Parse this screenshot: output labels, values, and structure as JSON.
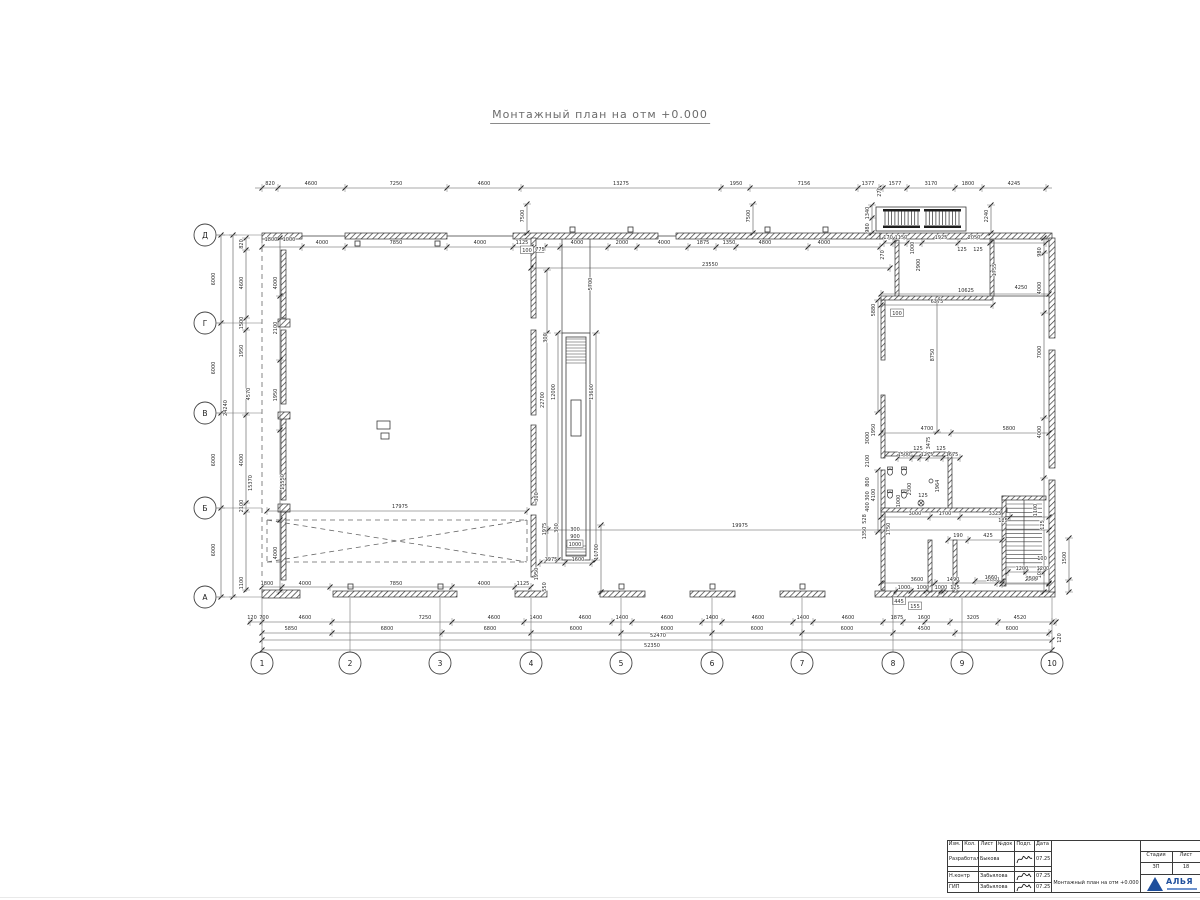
{
  "page": {
    "title": "Монтажный план на отм +0.000"
  },
  "plan": {
    "axes_bottom": [
      {
        "label": "1",
        "x": 262
      },
      {
        "label": "2",
        "x": 350
      },
      {
        "label": "3",
        "x": 440
      },
      {
        "label": "4",
        "x": 531
      },
      {
        "label": "5",
        "x": 621
      },
      {
        "label": "6",
        "x": 712
      },
      {
        "label": "7",
        "x": 802
      },
      {
        "label": "8",
        "x": 893
      },
      {
        "label": "9",
        "x": 962
      },
      {
        "label": "10",
        "x": 1052
      }
    ],
    "axes_left": [
      {
        "label": "Д",
        "y": 235
      },
      {
        "label": "Г",
        "y": 323
      },
      {
        "label": "В",
        "y": 413
      },
      {
        "label": "Б",
        "y": 508
      },
      {
        "label": "А",
        "y": 597
      }
    ],
    "dim_labels": [
      [
        270,
        185,
        "820"
      ],
      [
        311,
        185,
        "4600"
      ],
      [
        396,
        185,
        "7250"
      ],
      [
        484,
        185,
        "4600"
      ],
      [
        621,
        185,
        "13275"
      ],
      [
        736,
        185,
        "1950"
      ],
      [
        804,
        185,
        "7156"
      ],
      [
        868,
        185,
        "1377"
      ],
      [
        881,
        192,
        "270",
        1
      ],
      [
        895,
        185,
        "1577"
      ],
      [
        931,
        185,
        "3170"
      ],
      [
        968,
        185,
        "1800"
      ],
      [
        1014,
        185,
        "4245"
      ],
      [
        271,
        241,
        "1800"
      ],
      [
        289,
        241,
        "1000"
      ],
      [
        322,
        244,
        "4000"
      ],
      [
        396,
        244,
        "7850"
      ],
      [
        480,
        244,
        "4000"
      ],
      [
        522,
        244,
        "1125"
      ],
      [
        527,
        252,
        "100",
        0,
        1
      ],
      [
        540,
        251,
        "775",
        0,
        2
      ],
      [
        577,
        244,
        "4000"
      ],
      [
        622,
        244,
        "2000"
      ],
      [
        664,
        244,
        "4000"
      ],
      [
        703,
        244,
        "1875"
      ],
      [
        729,
        244,
        "1350"
      ],
      [
        765,
        244,
        "4800"
      ],
      [
        824,
        244,
        "4000"
      ],
      [
        888,
        239,
        "170"
      ],
      [
        901,
        239,
        "1150"
      ],
      [
        914,
        248,
        "1000",
        1
      ],
      [
        941,
        239,
        "1925"
      ],
      [
        974,
        239,
        "2050"
      ],
      [
        962,
        251,
        "125"
      ],
      [
        978,
        251,
        "125"
      ],
      [
        884,
        255,
        "270",
        1
      ],
      [
        920,
        265,
        "2900",
        1
      ],
      [
        996,
        270,
        "1755",
        1
      ],
      [
        524,
        216,
        "7500",
        1
      ],
      [
        750,
        216,
        "7500",
        1
      ],
      [
        710,
        266,
        "23550"
      ],
      [
        592,
        284,
        "5700",
        1
      ],
      [
        869,
        213,
        "1340",
        1
      ],
      [
        869,
        228,
        "980",
        1
      ],
      [
        988,
        216,
        "2240",
        1
      ],
      [
        1041,
        252,
        "980",
        1
      ],
      [
        1041,
        288,
        "4000",
        1
      ],
      [
        1041,
        352,
        "7000",
        1
      ],
      [
        1041,
        432,
        "4000",
        1
      ],
      [
        1044,
        525,
        "125",
        1
      ],
      [
        1041,
        572,
        "1080",
        1
      ],
      [
        1066,
        558,
        "1500",
        1
      ],
      [
        1061,
        638,
        "120",
        1
      ],
      [
        937,
        303,
        "6375"
      ],
      [
        1021,
        289,
        "4250"
      ],
      [
        966,
        292,
        "10625"
      ],
      [
        934,
        355,
        "8750",
        1
      ],
      [
        875,
        310,
        "5880",
        1
      ],
      [
        897,
        315,
        "100",
        0,
        1
      ],
      [
        875,
        430,
        "1950",
        1
      ],
      [
        875,
        495,
        "4100",
        1
      ],
      [
        927,
        430,
        "4700"
      ],
      [
        1009,
        430,
        "5800"
      ],
      [
        869,
        438,
        "3000",
        1
      ],
      [
        930,
        443,
        "3475",
        1
      ],
      [
        869,
        461,
        "2100",
        1
      ],
      [
        904,
        456,
        "1500"
      ],
      [
        927,
        456,
        "1275"
      ],
      [
        952,
        456,
        "1675"
      ],
      [
        918,
        450,
        "125"
      ],
      [
        941,
        450,
        "125"
      ],
      [
        869,
        482,
        "800",
        1
      ],
      [
        869,
        496,
        "300",
        1
      ],
      [
        869,
        507,
        "400",
        1
      ],
      [
        866,
        519,
        "528",
        1
      ],
      [
        866,
        533,
        "1350",
        1
      ],
      [
        911,
        489,
        "2300",
        1
      ],
      [
        939,
        486,
        "1964",
        1
      ],
      [
        900,
        501,
        "1000",
        1
      ],
      [
        923,
        497,
        "125"
      ],
      [
        915,
        515,
        "3000"
      ],
      [
        945,
        515,
        "1700"
      ],
      [
        995,
        515,
        "3325"
      ],
      [
        890,
        529,
        "1750",
        1
      ],
      [
        958,
        537,
        "190"
      ],
      [
        988,
        537,
        "425"
      ],
      [
        1003,
        522,
        "125"
      ],
      [
        917,
        581,
        "3600"
      ],
      [
        953,
        581,
        "1490"
      ],
      [
        993,
        581,
        "2660"
      ],
      [
        1031,
        581,
        "2500"
      ],
      [
        904,
        589,
        "1000"
      ],
      [
        923,
        589,
        "1000"
      ],
      [
        941,
        589,
        "1000"
      ],
      [
        955,
        589,
        "125"
      ],
      [
        1037,
        510,
        "1100",
        1
      ],
      [
        1042,
        560,
        "100"
      ],
      [
        1022,
        570,
        "1200"
      ],
      [
        1043,
        570,
        "1200"
      ],
      [
        1032,
        580,
        "2500"
      ],
      [
        991,
        579,
        "1660"
      ],
      [
        899,
        603,
        "445",
        0,
        1
      ],
      [
        915,
        608,
        "155",
        0,
        1
      ],
      [
        400,
        508,
        "17975"
      ],
      [
        740,
        527,
        "19975"
      ],
      [
        267,
        585,
        "1800"
      ],
      [
        305,
        585,
        "4000"
      ],
      [
        396,
        585,
        "7850"
      ],
      [
        484,
        585,
        "4000"
      ],
      [
        523,
        585,
        "1125"
      ],
      [
        538,
        574,
        "1950",
        1
      ],
      [
        546,
        587,
        "550",
        1
      ],
      [
        538,
        497,
        "300",
        1
      ],
      [
        546,
        529,
        "1975",
        1
      ],
      [
        544,
        400,
        "22700",
        1
      ],
      [
        555,
        392,
        "12000",
        1
      ],
      [
        593,
        392,
        "13600",
        1
      ],
      [
        547,
        338,
        "300",
        1
      ],
      [
        558,
        528,
        "300",
        1
      ],
      [
        575,
        531,
        "300"
      ],
      [
        575,
        538,
        "900",
        0,
        2
      ],
      [
        575,
        546,
        "1000",
        0,
        1
      ],
      [
        551,
        561,
        "1975"
      ],
      [
        578,
        561,
        "1600"
      ],
      [
        598,
        552,
        "11700",
        1
      ],
      [
        215,
        279,
        "6000",
        1
      ],
      [
        215,
        368,
        "6000",
        1
      ],
      [
        215,
        460,
        "6000",
        1
      ],
      [
        215,
        550,
        "6000",
        1
      ],
      [
        227,
        408,
        "24240",
        1
      ],
      [
        243,
        244,
        "820",
        1
      ],
      [
        243,
        283,
        "4600",
        1
      ],
      [
        243,
        323,
        "1500",
        1
      ],
      [
        243,
        351,
        "1950",
        1
      ],
      [
        250,
        394,
        "4570",
        1
      ],
      [
        243,
        460,
        "4000",
        1
      ],
      [
        243,
        506,
        "2100",
        1
      ],
      [
        243,
        583,
        "1100",
        1
      ],
      [
        277,
        283,
        "4000",
        1
      ],
      [
        277,
        328,
        "2100",
        1
      ],
      [
        277,
        395,
        "1950",
        1
      ],
      [
        252,
        483,
        "15370",
        1
      ],
      [
        284,
        482,
        "15550",
        1
      ],
      [
        277,
        553,
        "4000",
        1
      ],
      [
        252,
        619,
        "120"
      ],
      [
        264,
        619,
        "700"
      ],
      [
        305,
        619,
        "4600"
      ],
      [
        425,
        619,
        "7250"
      ],
      [
        494,
        619,
        "4600"
      ],
      [
        536,
        619,
        "1400"
      ],
      [
        585,
        619,
        "4600"
      ],
      [
        622,
        619,
        "1400"
      ],
      [
        667,
        619,
        "4600"
      ],
      [
        712,
        619,
        "1400"
      ],
      [
        758,
        619,
        "4600"
      ],
      [
        803,
        619,
        "1400"
      ],
      [
        848,
        619,
        "4600"
      ],
      [
        897,
        619,
        "1875"
      ],
      [
        924,
        619,
        "1600"
      ],
      [
        973,
        619,
        "3205"
      ],
      [
        1020,
        619,
        "4520"
      ],
      [
        291,
        630,
        "5850"
      ],
      [
        387,
        630,
        "6800"
      ],
      [
        490,
        630,
        "6800"
      ],
      [
        576,
        630,
        "6000"
      ],
      [
        667,
        630,
        "6000"
      ],
      [
        757,
        630,
        "6000"
      ],
      [
        847,
        630,
        "6000"
      ],
      [
        924,
        630,
        "4500"
      ],
      [
        1012,
        630,
        "6000"
      ],
      [
        658,
        637,
        "52470"
      ],
      [
        652,
        647,
        "52350"
      ]
    ]
  },
  "titleblock": {
    "headers": [
      "Изм.",
      "Кол.",
      "Лист",
      "№док",
      "Подп.",
      "Дата"
    ],
    "rows": [
      {
        "role": "Разработал",
        "name": "Быкова",
        "date": "07.25"
      },
      {
        "role": "Н.контр",
        "name": "Забьялова",
        "date": "07.25"
      },
      {
        "role": "ГИП",
        "name": "Забьялова",
        "date": "07.25"
      }
    ],
    "doc_title": "Монтажный план на отм +0.000",
    "stage_label": "Стадия",
    "stage": "ЗП",
    "sheet_label": "Лист",
    "sheet": "18",
    "logo_text": "АЛЬЯ",
    "logo_color": "#1f4f9c"
  }
}
